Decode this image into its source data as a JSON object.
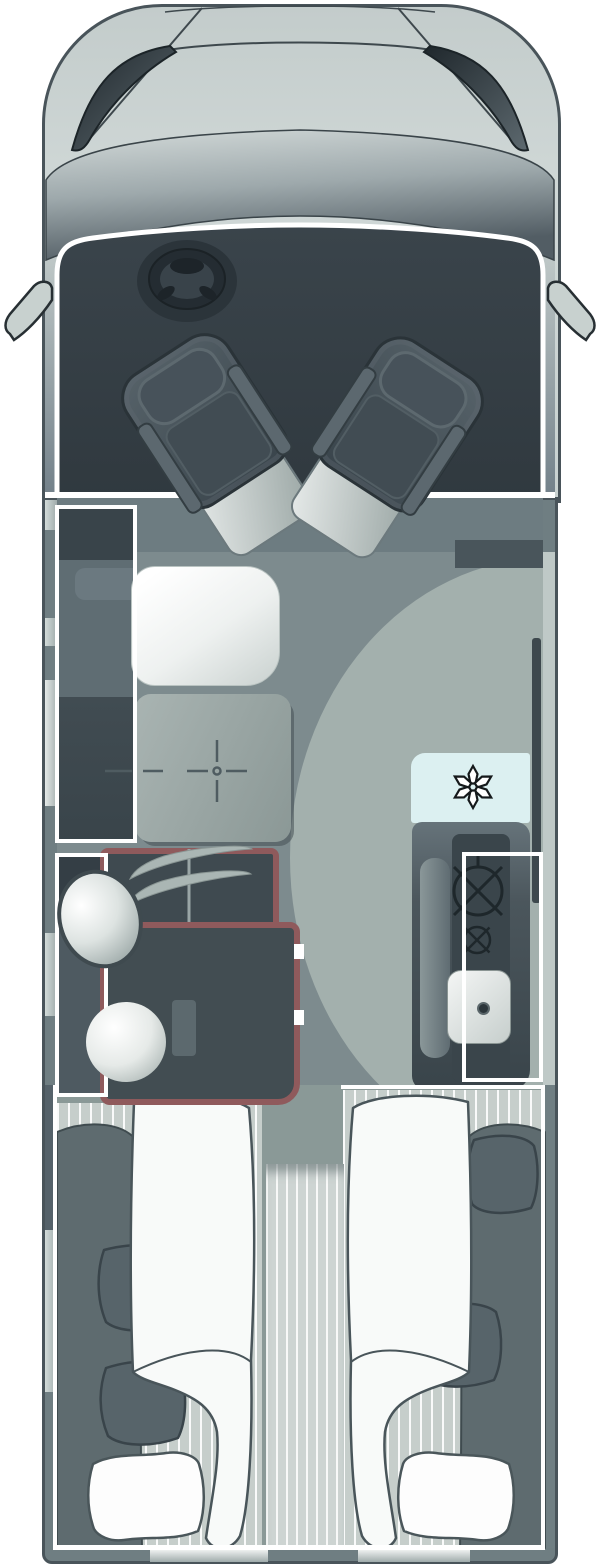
{
  "diagram": {
    "type": "motorhome-floor-plan-top-view",
    "orientation": "front-of-vehicle-at-top",
    "visible_text": [],
    "rooms": {
      "cab": {
        "label": "Cab",
        "fixtures": [
          "steering-wheel",
          "driver-swivel-seat",
          "passenger-swivel-seat",
          "windshield",
          "hood",
          "left-wing-mirror",
          "right-wing-mirror"
        ]
      },
      "lounge": {
        "label": "Lounge",
        "fixtures": [
          "sideboard-unit",
          "side-sofa",
          "pedestal-table",
          "table-position-marks",
          "floor-arc"
        ]
      },
      "kitchen": {
        "label": "Kitchen",
        "fixtures": [
          "refrigerator",
          "worktop",
          "two-burner-hob",
          "sink",
          "partition-wall"
        ]
      },
      "washroom": {
        "label": "Washroom",
        "fixtures": [
          "wardrobe-hanging-rail",
          "shower-cubicle",
          "washbasin",
          "toilet",
          "door-hinges"
        ]
      },
      "bedroom": {
        "label": "Rear twin single beds",
        "fixtures": [
          "left-single-bed",
          "right-single-bed",
          "center-step",
          "duvets",
          "white-pillows",
          "dark-cushions",
          "blankets"
        ]
      }
    },
    "icons": [
      {
        "name": "snowflake-icon",
        "meaning": "refrigerator / freezer"
      },
      {
        "name": "burner-icon-large",
        "meaning": "gas hob large burner"
      },
      {
        "name": "burner-icon-small",
        "meaning": "gas hob small burner"
      },
      {
        "name": "crosshair-icon",
        "meaning": "adjustable table position marks"
      },
      {
        "name": "drain-icon",
        "meaning": "sink drain"
      }
    ],
    "colors": {
      "body": "#ccd4d3",
      "outline": "#49545a",
      "wall": "#6f7e82",
      "window": "#c6d0ce",
      "cab_interior": "#39434a",
      "floor": "#7d8b8e",
      "floor_light": "#a3b0ad",
      "wet_room_accent": "#8f5a5c",
      "fridge": "#dcf0f1",
      "white_lines": "#ffffff",
      "mattress": "#c6cecb",
      "blanket": "#5e6b6f",
      "seat": "#46525a",
      "table": "#97a4a2"
    }
  }
}
